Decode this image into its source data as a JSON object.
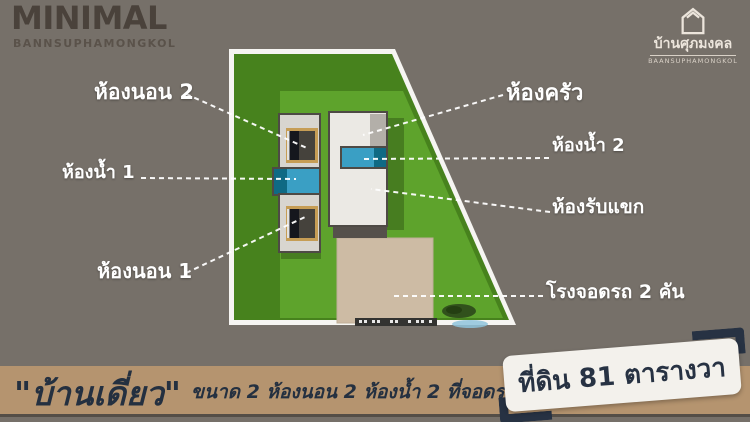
{
  "header": {
    "brand": {
      "title": "MINIMAL",
      "subtitle": "BANNSUPHAMONGKOL"
    },
    "logo": {
      "icon": "house-outline-icon",
      "thai_name": "บ้านศุภมงคล",
      "latin_name": "BAANSUPHAMONGKOL"
    }
  },
  "plan": {
    "labels": [
      {
        "id": "bedroom-2",
        "text": "ห้องนอน 2"
      },
      {
        "id": "kitchen",
        "text": "ห้องครัว"
      },
      {
        "id": "bathroom-2",
        "text": "ห้องน้ำ 2"
      },
      {
        "id": "bathroom-1",
        "text": "ห้องน้ำ 1"
      },
      {
        "id": "living-room",
        "text": "ห้องรับแขก"
      },
      {
        "id": "bedroom-1",
        "text": "ห้องนอน 1"
      },
      {
        "id": "garage",
        "text": "โรงจอดรถ 2 คัน"
      }
    ]
  },
  "footer": {
    "house_type": "\"บ้านเดี่ยว\"",
    "spec_text": "ขนาด 2 ห้องนอน 2 ห้องน้ำ 2 ที่จอดรถ",
    "land_badge": "ที่ดิน 81 ตารางวา"
  },
  "colors": {
    "background": "#767069",
    "footer_bar": "#b5946f",
    "navy_text": "#263140",
    "lawn_dark": "#47821d",
    "lawn_light": "#5ea32c",
    "plot_border_white": "#f6f5f2",
    "house_floor": "#ebe9e4",
    "bedroom_floor": "#d8d5cf",
    "bathroom_blue": "#3a9fc4",
    "bathroom_teal": "#0f6a84",
    "garage_pad_tan": "#cdbba4",
    "bed_frame_gold": "#c69d55",
    "wall_gray": "#4e4a45",
    "label_text": "#ffffff"
  }
}
